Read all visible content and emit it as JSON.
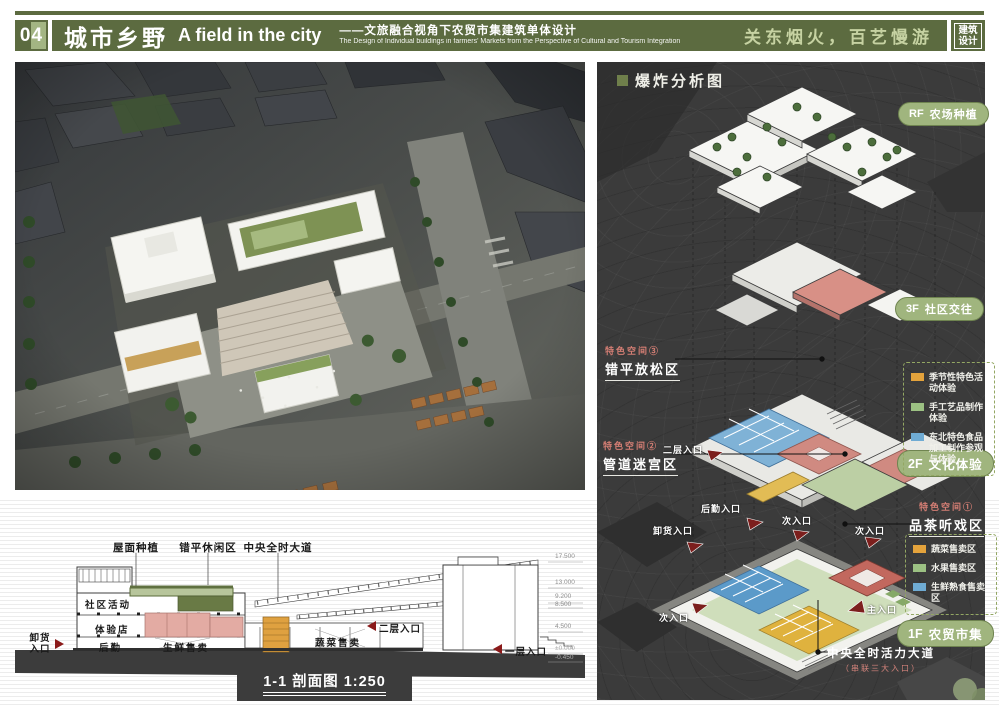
{
  "header": {
    "number": "04",
    "title_cn": "城市乡野",
    "title_en": "A field in the city",
    "subtitle_cn": "——文旅融合视角下农贸市集建筑单体设计",
    "subtitle_en": "The Design of Individual buildings in farmers' Markets from the Perspective of Cultural and Tourism Integration",
    "slogan": "关东烟火，百艺慢游",
    "badge": [
      "建筑",
      "设计"
    ],
    "bar_color": "#5C6B40"
  },
  "section": {
    "top_labels": [
      "屋面种植",
      "错平休闲区",
      "中央全时大道"
    ],
    "rooms": [
      "社区活动",
      "体验店",
      "后勤",
      "生鲜售卖",
      "蔬菜售卖"
    ],
    "entrances": {
      "unload": "卸货入口",
      "second": "二层入口",
      "first": "一层入口"
    },
    "elevations": [
      "17.500",
      "13.000",
      "9.200",
      "8.500",
      "4.500",
      "±0.000",
      "-0.450"
    ],
    "title": "1-1 剖面图 1:250"
  },
  "axon": {
    "title": "爆炸分析图",
    "floors": [
      {
        "code": "RF",
        "label": "农场种植"
      },
      {
        "code": "3F",
        "label": "社区交往"
      },
      {
        "code": "2F",
        "label": "文化体验"
      },
      {
        "code": "1F",
        "label": "农贸市集"
      }
    ],
    "legend_2f": [
      {
        "color": "#E4A33C",
        "label": "季节性特色活动体验"
      },
      {
        "color": "#9CC183",
        "label": "手工艺品制作体验"
      },
      {
        "color": "#6FABD3",
        "label": "东北特色食品加工制作参观与体验"
      }
    ],
    "legend_1f": [
      {
        "color": "#E4A33C",
        "label": "蔬菜售卖区"
      },
      {
        "color": "#9CC183",
        "label": "水果售卖区"
      },
      {
        "color": "#6FABD3",
        "label": "生鲜熟食售卖区"
      }
    ],
    "features": [
      {
        "tag": "特色空间③",
        "label": "错平放松区"
      },
      {
        "tag": "特色空间②",
        "label": "管道迷宫区"
      },
      {
        "tag": "特色空间①",
        "label": "品茶听戏区"
      }
    ],
    "entrances": {
      "logistics": "后勤入口",
      "unloading": "卸货入口",
      "secondary_a": "次入口",
      "secondary_b": "次入口",
      "secondary_c": "次入口",
      "main": "主入口",
      "second_floor": "二层入口"
    },
    "avenue": {
      "label": "中央全时活力大道",
      "sub": "（串联三大入口）"
    }
  }
}
